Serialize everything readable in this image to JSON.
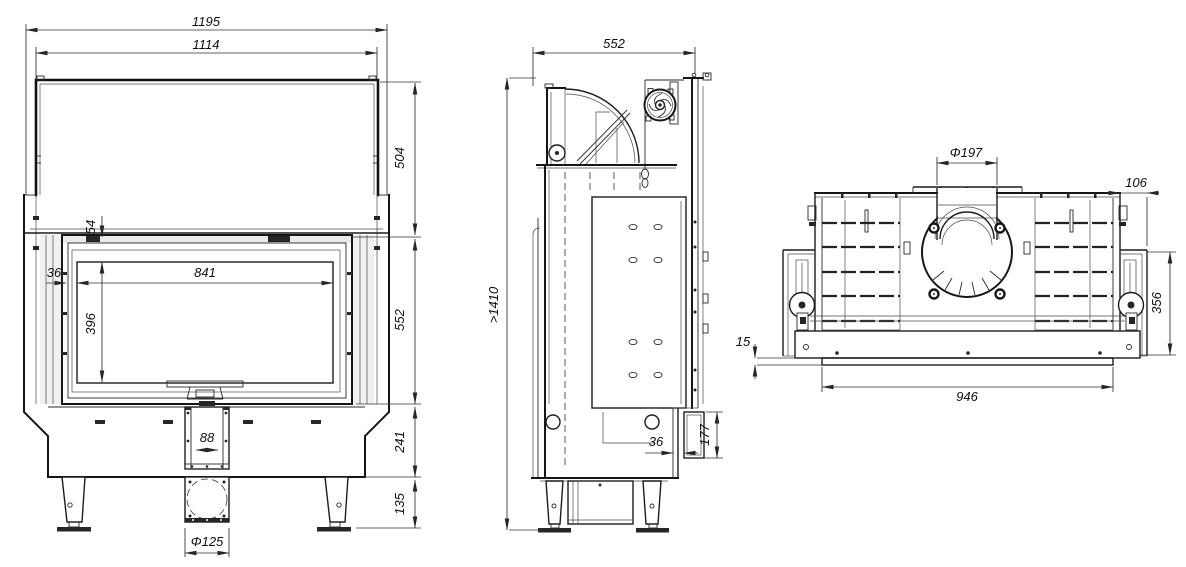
{
  "drawing": {
    "front": {
      "dims": {
        "overall_width": "1195",
        "top_width": "1114",
        "hood_height": "504",
        "lintel_drop": "54",
        "glass_margin": "36",
        "glass_width": "841",
        "glass_height": "396",
        "front_height": "552",
        "duct_width": "88",
        "base_height": "241",
        "leg_height": "135",
        "inlet_diameter": "Φ125"
      }
    },
    "side": {
      "dims": {
        "depth": "552",
        "total_height": ">1410",
        "flange_depth": "36",
        "flange_height": "177"
      }
    },
    "top": {
      "dims": {
        "flue_diameter": "Φ197",
        "side_overhang": "106",
        "lip_offset": "15",
        "depth": "356",
        "front_width": "946"
      }
    },
    "colors": {
      "background": "#ffffff",
      "line": "#1a1a1a",
      "dimension_text": "#0e0e0e"
    }
  }
}
